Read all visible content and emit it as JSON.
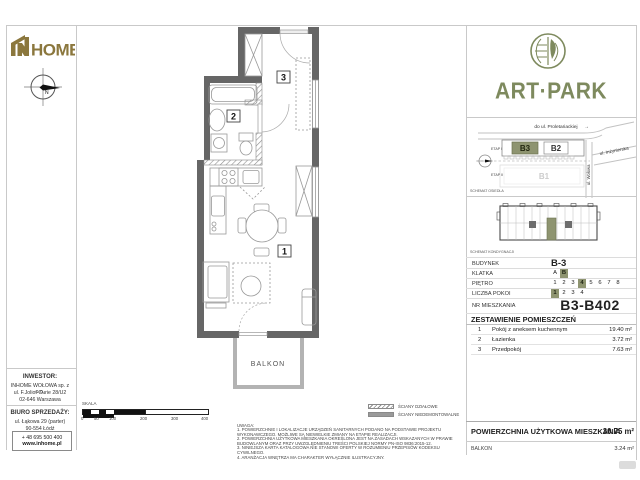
{
  "branding": {
    "inhome": "INHOME",
    "home_suffix": "HOME",
    "artpark": "ART·PARK"
  },
  "colors": {
    "accent_olive": "#8e9470",
    "brand_gold": "#8b773d",
    "brand_green": "#7e8a5e"
  },
  "sidebar": {
    "investor_title": "INWESTOR:",
    "investor_lines": [
      "INHOME WOŁOWA sp. z o.o.",
      "ul. F.Joliot-Curie 28/U2",
      "02-646 Warszawa"
    ],
    "office_title": "BIURO SPRZEDAŻY:",
    "office_lines": [
      "ul. Łąkowa 29 (parter)",
      "90-554 Łódź"
    ],
    "phone": "+ 48 695 500 400",
    "website": "www.inhome.pl"
  },
  "site_plan": {
    "street_top": "do ul. Proletariackiej",
    "arrow": "→",
    "street_diag": "ul. Inżynierska",
    "street_right": "ul. Wołowa",
    "etap1": "ETAP I",
    "etap2": "ETAP II",
    "b3": "B3",
    "b2": "B2",
    "b1": "B1",
    "caption": "SCHEMAT OSIEDLA"
  },
  "floor_schematic": {
    "caption": "SCHEMAT KONDYGNACJI"
  },
  "unit": {
    "budynek_label": "BUDYNEK",
    "budynek_value": "B-3",
    "klatka_label": "KLATKA",
    "klatka_options": [
      "A",
      "B"
    ],
    "pietro_label": "PIĘTRO",
    "pietro_options": [
      "1",
      "2",
      "3",
      "4",
      "5",
      "6",
      "7",
      "8"
    ],
    "pokoje_label": "LICZBA POKOI",
    "pokoje_options": [
      "1",
      "2",
      "3",
      "4"
    ],
    "nr_label": "NR MIESZKANIA",
    "nr_value": "B3-B402"
  },
  "rooms": {
    "title": "ZESTAWIENIE POMIESZCZEŃ",
    "items": [
      {
        "no": "1",
        "name": "Pokój z aneksem kuchennym",
        "area": "19.40 m²"
      },
      {
        "no": "2",
        "name": "Łazienka",
        "area": "3.72 m²"
      },
      {
        "no": "3",
        "name": "Przedpokój",
        "area": "7.63 m²"
      }
    ]
  },
  "totals": {
    "area_label": "POWIERZCHNIA UŻYTKOWA MIESZKANIA",
    "area_value": "30.75 m²",
    "balkon_label": "BALKON",
    "balkon_value": "3.24 m²"
  },
  "plan": {
    "room1": "1",
    "room2": "2",
    "room3": "3",
    "balkon": "BALKON"
  },
  "legend": {
    "items": [
      "ŚCIANY DZIAŁOWE",
      "ŚCIANY NIEDEMONTOWALNE"
    ]
  },
  "scale": {
    "label": "SKALA",
    "ticks": [
      "0",
      "50",
      "100",
      "200",
      "300",
      "400"
    ]
  },
  "notes": {
    "title": "UWAGA:",
    "lines": [
      "1. POWIERZCHNIE I LOKALIZACJE URZĄDZEŃ SANITARNYCH PODANO NA PODSTAWIE PROJEKTU WYKONAWCZEGO. MOŻLIWE SĄ NIEWIELKIE ZMIANY NA ETAPIE REALIZACJI.",
      "2. POWIERZCHNIA UŻYTKOWA MIESZKANIA OKREŚLONA JEST NA ZASADACH WSKAZANYCH W PRAWIE",
      "BUDOWLANYM ORAZ PRZY UWZGLĘDNIENIU TREŚCI POLSKIEJ NORMY PN-ISO 9836:2015-12.",
      "3. NINIEJSZA KARTA KATALOGOWA NIE STANOWI OFERTY W ROZUMIENIU PRZEPISÓW KODEKSU CYWILNEGO.",
      "4. ARANŻACJA WNĘTRZA MA CHARAKTER WYŁĄCZNIE ILUSTRACYJNY."
    ]
  }
}
